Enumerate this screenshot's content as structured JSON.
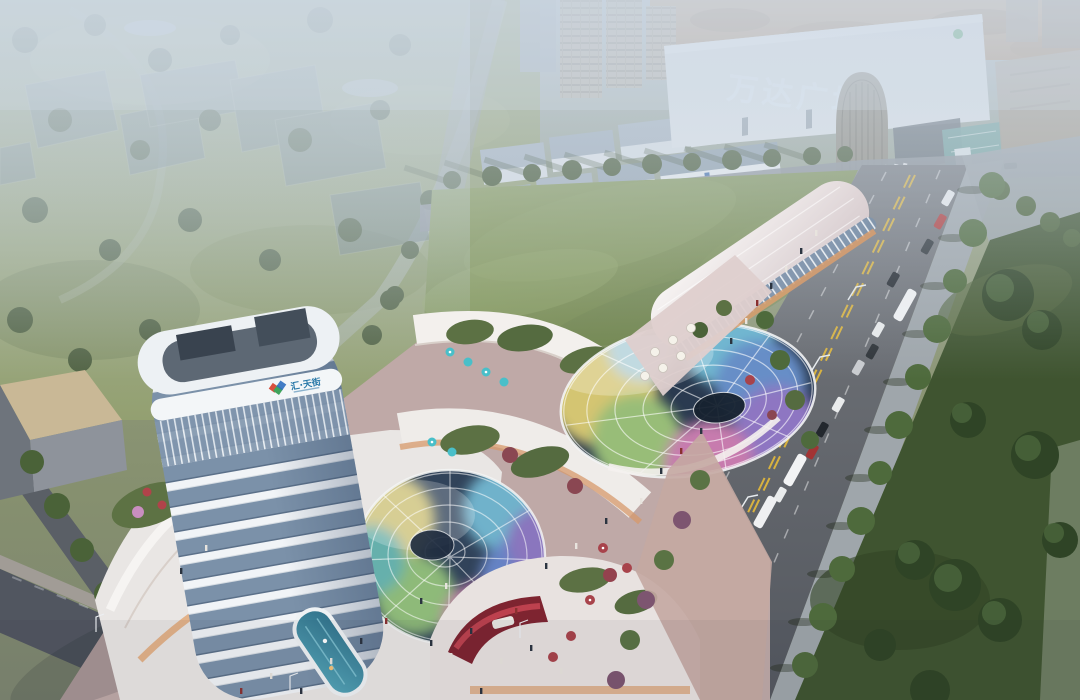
{
  "meta": {
    "type": "architectural-aerial-rendering",
    "time_of_day": "dusk",
    "description": "Aerial dusk rendering of a mixed-use retail development: a curved white tower with rooftop logo, two iridescent rainbow glass canopies over sunken courts, curved white podium terraces with gardens and umbrellas, a long capsule-shaped retail building, a tree-lined arterial road with buses and cars, a large central lawn, faded master-plan massing blocks in a park, and the Wanda Plaza mall in the hazy background."
  },
  "signage": {
    "mall_sign": "万达广场",
    "tower_logo_text": "汇·天街"
  },
  "palette": {
    "haze": "#cdd8e4",
    "park_green": "#95a273",
    "lawn_green": "#7d9055",
    "dark_lawn": "#3f5430",
    "road_grey": "#63666c",
    "plaza_pink": "#c0aaa8",
    "tower_white": "#eff3f6",
    "glass_blue": "#7b91a9",
    "canopy_yellow": "#ecd977",
    "canopy_cyan": "#7cc9e2",
    "canopy_purple": "#9c7fd2",
    "canopy_magenta": "#dd85bb",
    "accent_red": "#a03a42",
    "umbrella_teal": "#49bfc9",
    "lane_yellow": "#d8b23f"
  },
  "scene_elements": [
    "ghost-master-plan-blocks",
    "wanda-plaza-mall",
    "residential-towers",
    "old-town-shops",
    "arch-gateway",
    "central-lawn",
    "office-tower",
    "rainbow-glass-dome",
    "rainbow-vortex-canopy",
    "retail-strip-building",
    "podium-terraces",
    "rooftop-pool",
    "red-led-screen",
    "arterial-road",
    "street-trees",
    "vehicles",
    "pedestrians",
    "plaza",
    "warehouse-building"
  ]
}
